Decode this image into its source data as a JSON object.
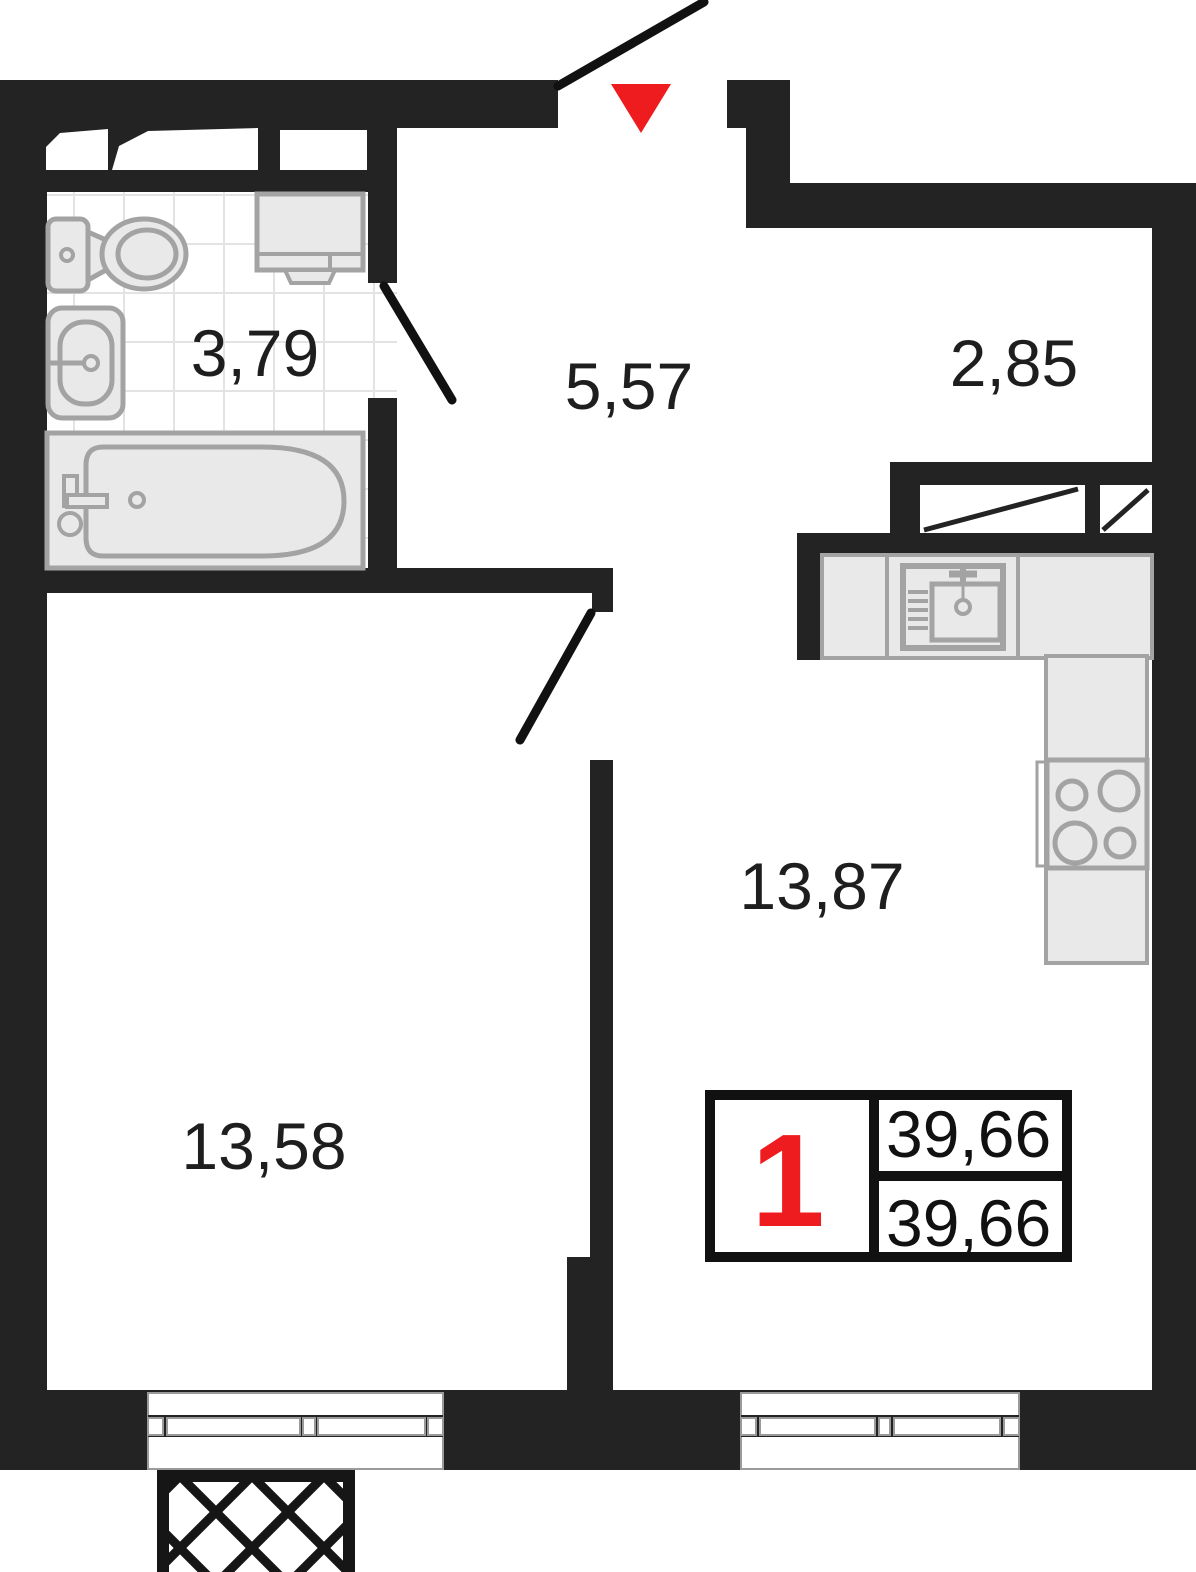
{
  "plan": {
    "title": "apartment-floor-plan",
    "rooms": {
      "bathroom": {
        "label": "3,79"
      },
      "hallway": {
        "label": "5,57"
      },
      "loggia": {
        "label": "2,85"
      },
      "kitchen_living": {
        "label": "13,87"
      },
      "bedroom": {
        "label": "13,58"
      }
    },
    "stamp": {
      "rooms_count": "1",
      "area_top": "39,66",
      "area_bottom": "39,66"
    },
    "fixtures": [
      "toilet-icon",
      "washbasin-icon",
      "bathtub-icon",
      "washing-machine-icon",
      "kitchen-sink-icon",
      "stove-icon",
      "entrance-arrow-icon",
      "balcony-hatch"
    ],
    "colors": {
      "wall": "#232323",
      "fixture_fill": "#e9e9e9",
      "fixture_stroke": "#a3a3a3",
      "accent_red": "#ee1b1f",
      "tile_line": "#e3e3e3"
    }
  }
}
